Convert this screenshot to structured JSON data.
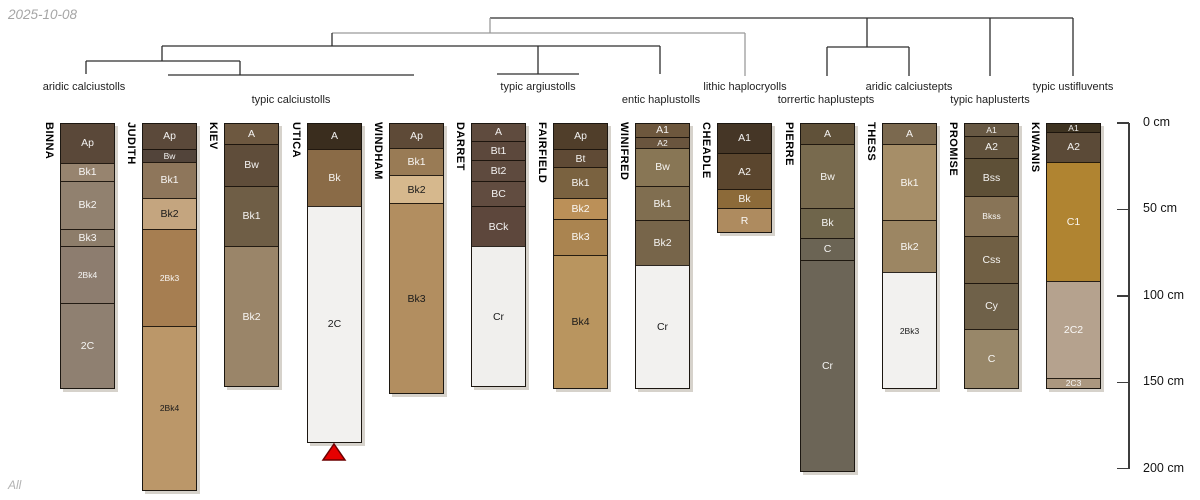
{
  "date_label": "2025-10-08",
  "footer_label": "All",
  "depth_axis": {
    "unit": "cm",
    "ticks": [
      {
        "value": 0,
        "label": "0 cm"
      },
      {
        "value": 50,
        "label": "50 cm"
      },
      {
        "value": 100,
        "label": "100 cm"
      },
      {
        "value": 150,
        "label": "150 cm"
      },
      {
        "value": 200,
        "label": "200 cm"
      }
    ]
  },
  "chart_data": {
    "type": "bar",
    "subtype": "soil-profile-sketches-with-dendrogram",
    "ylabel": "depth (cm)",
    "ylim": [
      0,
      200
    ],
    "group_labels": [
      {
        "text": "aridic calciustolls",
        "x": 84,
        "row": 1
      },
      {
        "text": "typic calciustolls",
        "x": 291,
        "row": 2
      },
      {
        "text": "typic argiustolls",
        "x": 538,
        "row": 1
      },
      {
        "text": "entic haplustolls",
        "x": 661,
        "row": 2
      },
      {
        "text": "lithic haplocryolls",
        "x": 745,
        "row": 1
      },
      {
        "text": "torrertic haplustepts",
        "x": 826,
        "row": 2
      },
      {
        "text": "aridic calciustepts",
        "x": 909,
        "row": 1
      },
      {
        "text": "typic haplusterts",
        "x": 990,
        "row": 2
      },
      {
        "text": "typic ustifluvents",
        "x": 1073,
        "row": 1
      }
    ],
    "tree_segments": [
      {
        "x1": 490,
        "y1": 18,
        "x2": 1073,
        "y2": 18
      },
      {
        "x1": 490,
        "y1": 18,
        "x2": 490,
        "y2": 33,
        "gray": true
      },
      {
        "x1": 332,
        "y1": 33,
        "x2": 745,
        "y2": 33,
        "gray": true
      },
      {
        "x1": 745,
        "y1": 33,
        "x2": 745,
        "y2": 76,
        "gray": true
      },
      {
        "x1": 332,
        "y1": 33,
        "x2": 332,
        "y2": 46
      },
      {
        "x1": 162,
        "y1": 46,
        "x2": 660,
        "y2": 46
      },
      {
        "x1": 162,
        "y1": 46,
        "x2": 162,
        "y2": 61
      },
      {
        "x1": 86,
        "y1": 61,
        "x2": 240,
        "y2": 61
      },
      {
        "x1": 86,
        "y1": 61,
        "x2": 86,
        "y2": 74
      },
      {
        "x1": 240,
        "y1": 61,
        "x2": 240,
        "y2": 75
      },
      {
        "x1": 168,
        "y1": 75,
        "x2": 414,
        "y2": 75
      },
      {
        "x1": 538,
        "y1": 46,
        "x2": 538,
        "y2": 74
      },
      {
        "x1": 497,
        "y1": 74,
        "x2": 579,
        "y2": 74
      },
      {
        "x1": 660,
        "y1": 46,
        "x2": 660,
        "y2": 74
      },
      {
        "x1": 867,
        "y1": 18,
        "x2": 867,
        "y2": 47
      },
      {
        "x1": 827,
        "y1": 47,
        "x2": 909,
        "y2": 47
      },
      {
        "x1": 827,
        "y1": 47,
        "x2": 827,
        "y2": 76
      },
      {
        "x1": 909,
        "y1": 47,
        "x2": 909,
        "y2": 76
      },
      {
        "x1": 990,
        "y1": 18,
        "x2": 990,
        "y2": 76
      },
      {
        "x1": 1073,
        "y1": 18,
        "x2": 1073,
        "y2": 76
      }
    ],
    "marker": {
      "shape": "triangle-up",
      "profile": "UTICA",
      "fill": "#e60000",
      "stroke": "#6b0000"
    },
    "profiles": [
      {
        "name": "BINNA",
        "horizons": [
          {
            "name": "Ap",
            "top": 0,
            "bottom": 23,
            "color": "#5a4839"
          },
          {
            "name": "Bk1",
            "top": 23,
            "bottom": 33,
            "color": "#97846f"
          },
          {
            "name": "Bk2",
            "top": 33,
            "bottom": 61,
            "color": "#91816f"
          },
          {
            "name": "Bk3",
            "top": 61,
            "bottom": 71,
            "color": "#8d7d6a"
          },
          {
            "name": "2Bk4",
            "top": 71,
            "bottom": 104,
            "color": "#8d7d6f"
          },
          {
            "name": "2C",
            "top": 104,
            "bottom": 153,
            "color": "#8f8071"
          }
        ]
      },
      {
        "name": "JUDITH",
        "horizons": [
          {
            "name": "Ap",
            "top": 0,
            "bottom": 15,
            "color": "#5b493a"
          },
          {
            "name": "Bw",
            "top": 15,
            "bottom": 22,
            "color": "#52443a"
          },
          {
            "name": "Bk1",
            "top": 22,
            "bottom": 43,
            "color": "#8e765b"
          },
          {
            "name": "Bk2",
            "top": 43,
            "bottom": 61,
            "color": "#c4a57f",
            "dark_label": true
          },
          {
            "name": "2Bk3",
            "top": 61,
            "bottom": 117,
            "color": "#a67e51"
          },
          {
            "name": "2Bk4",
            "top": 117,
            "bottom": 212,
            "color": "#bb9769",
            "dark_label": true
          }
        ]
      },
      {
        "name": "KIEV",
        "horizons": [
          {
            "name": "A",
            "top": 0,
            "bottom": 12,
            "color": "#6d5840"
          },
          {
            "name": "Bw",
            "top": 12,
            "bottom": 36,
            "color": "#5f4d3a"
          },
          {
            "name": "Bk1",
            "top": 36,
            "bottom": 71,
            "color": "#6f5e46"
          },
          {
            "name": "Bk2",
            "top": 71,
            "bottom": 152,
            "color": "#9a8569"
          }
        ]
      },
      {
        "name": "UTICA",
        "horizons": [
          {
            "name": "A",
            "top": 0,
            "bottom": 15,
            "color": "#3a2d1e"
          },
          {
            "name": "Bk",
            "top": 15,
            "bottom": 48,
            "color": "#8a6b47"
          },
          {
            "name": "2C",
            "top": 48,
            "bottom": 184,
            "color": "#f2f1ef",
            "dark_label": true
          }
        ]
      },
      {
        "name": "WINDHAM",
        "horizons": [
          {
            "name": "Ap",
            "top": 0,
            "bottom": 14,
            "color": "#5e4a37"
          },
          {
            "name": "Bk1",
            "top": 14,
            "bottom": 30,
            "color": "#997b55"
          },
          {
            "name": "Bk2",
            "top": 30,
            "bottom": 46,
            "color": "#d6b88d",
            "dark_label": true
          },
          {
            "name": "Bk3",
            "top": 46,
            "bottom": 156,
            "color": "#b28e60",
            "dark_label": true
          }
        ]
      },
      {
        "name": "DARRET",
        "horizons": [
          {
            "name": "A",
            "top": 0,
            "bottom": 10,
            "color": "#5f4b3e"
          },
          {
            "name": "Bt1",
            "top": 10,
            "bottom": 21,
            "color": "#5c483c"
          },
          {
            "name": "Bt2",
            "top": 21,
            "bottom": 33,
            "color": "#5e4a3e"
          },
          {
            "name": "BC",
            "top": 33,
            "bottom": 48,
            "color": "#614c40"
          },
          {
            "name": "BCk",
            "top": 48,
            "bottom": 71,
            "color": "#5d473c"
          },
          {
            "name": "Cr",
            "top": 71,
            "bottom": 152,
            "color": "#f0efed",
            "dark_label": true
          }
        ]
      },
      {
        "name": "FAIRFIELD",
        "horizons": [
          {
            "name": "Ap",
            "top": 0,
            "bottom": 15,
            "color": "#503e2a"
          },
          {
            "name": "Bt",
            "top": 15,
            "bottom": 25,
            "color": "#5f4a35"
          },
          {
            "name": "Bk1",
            "top": 25,
            "bottom": 43,
            "color": "#7a6240"
          },
          {
            "name": "Bk2",
            "top": 43,
            "bottom": 55,
            "color": "#bb9058"
          },
          {
            "name": "Bk3",
            "top": 55,
            "bottom": 76,
            "color": "#aa8450"
          },
          {
            "name": "Bk4",
            "top": 76,
            "bottom": 153,
            "color": "#b9955f",
            "dark_label": true
          }
        ]
      },
      {
        "name": "WINIFRED",
        "horizons": [
          {
            "name": "A1",
            "top": 0,
            "bottom": 8,
            "color": "#6d573d"
          },
          {
            "name": "A2",
            "top": 8,
            "bottom": 14,
            "color": "#6a553e"
          },
          {
            "name": "Bw",
            "top": 14,
            "bottom": 36,
            "color": "#887655"
          },
          {
            "name": "Bk1",
            "top": 36,
            "bottom": 56,
            "color": "#806e50"
          },
          {
            "name": "Bk2",
            "top": 56,
            "bottom": 82,
            "color": "#77654a"
          },
          {
            "name": "Cr",
            "top": 82,
            "bottom": 153,
            "color": "#f2f1ef",
            "dark_label": true
          }
        ]
      },
      {
        "name": "CHEADLE",
        "horizons": [
          {
            "name": "A1",
            "top": 0,
            "bottom": 17,
            "color": "#453626"
          },
          {
            "name": "A2",
            "top": 17,
            "bottom": 38,
            "color": "#5b462e"
          },
          {
            "name": "Bk",
            "top": 38,
            "bottom": 49,
            "color": "#8c6a39"
          },
          {
            "name": "R",
            "top": 49,
            "bottom": 63,
            "color": "#ae8b5f"
          }
        ]
      },
      {
        "name": "PIERRE",
        "horizons": [
          {
            "name": "A",
            "top": 0,
            "bottom": 12,
            "color": "#605139"
          },
          {
            "name": "Bw",
            "top": 12,
            "bottom": 49,
            "color": "#786a4e"
          },
          {
            "name": "Bk",
            "top": 49,
            "bottom": 66,
            "color": "#6f654b"
          },
          {
            "name": "C",
            "top": 66,
            "bottom": 79,
            "color": "#6b6454"
          },
          {
            "name": "Cr",
            "top": 79,
            "bottom": 201,
            "color": "#6c6557"
          }
        ]
      },
      {
        "name": "THESS",
        "horizons": [
          {
            "name": "A",
            "top": 0,
            "bottom": 12,
            "color": "#7b694f"
          },
          {
            "name": "Bk1",
            "top": 12,
            "bottom": 56,
            "color": "#a68e68"
          },
          {
            "name": "Bk2",
            "top": 56,
            "bottom": 86,
            "color": "#9c8663"
          },
          {
            "name": "2Bk3",
            "top": 86,
            "bottom": 153,
            "color": "#f2f1ef",
            "dark_label": true
          }
        ]
      },
      {
        "name": "PROMISE",
        "horizons": [
          {
            "name": "A1",
            "top": 0,
            "bottom": 7,
            "color": "#675843"
          },
          {
            "name": "A2",
            "top": 7,
            "bottom": 20,
            "color": "#61523c"
          },
          {
            "name": "Bss",
            "top": 20,
            "bottom": 42,
            "color": "#5e5037"
          },
          {
            "name": "Bkss",
            "top": 42,
            "bottom": 65,
            "color": "#887457"
          },
          {
            "name": "Css",
            "top": 65,
            "bottom": 92,
            "color": "#705f44"
          },
          {
            "name": "Cy",
            "top": 92,
            "bottom": 119,
            "color": "#6f6149"
          },
          {
            "name": "C",
            "top": 119,
            "bottom": 153,
            "color": "#988769"
          }
        ]
      },
      {
        "name": "KIWANIS",
        "horizons": [
          {
            "name": "A1",
            "top": 0,
            "bottom": 5,
            "color": "#3e3321"
          },
          {
            "name": "A2",
            "top": 5,
            "bottom": 22,
            "color": "#5b4a37"
          },
          {
            "name": "C1",
            "top": 22,
            "bottom": 91,
            "color": "#b08431"
          },
          {
            "name": "2C2",
            "top": 91,
            "bottom": 147,
            "color": "#b5a28e"
          },
          {
            "name": "2C3",
            "top": 147,
            "bottom": 153,
            "color": "#ab977f"
          }
        ]
      }
    ]
  }
}
